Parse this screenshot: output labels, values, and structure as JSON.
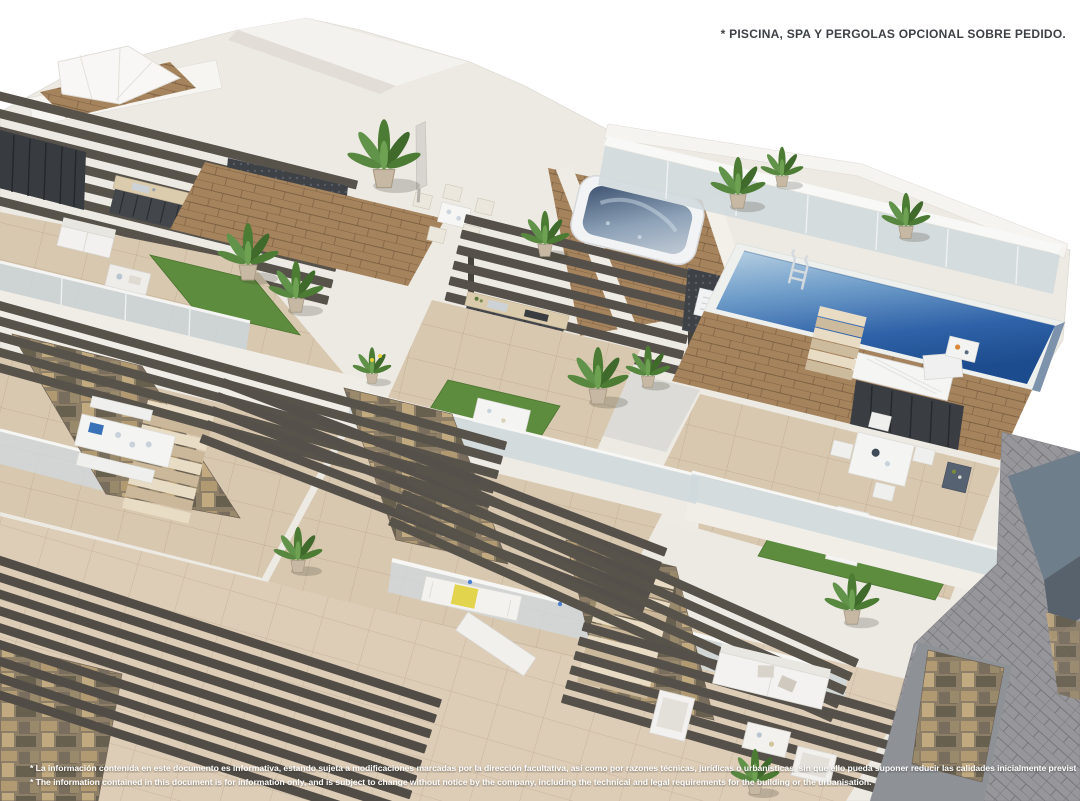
{
  "overlay": {
    "note_top_right": "* PISCINA, SPA Y PERGOLAS OPCIONAL SOBRE PEDIDO.",
    "disclaimer_es": "* La información contenida en este documento es informativa, estando sujeta a modificaciones marcadas por la dirección facultativa, así como por razones técnicas, jurídicas o urbanísticas, sin que ello pueda suponer reducir las calidades inicialmente previstas.",
    "disclaimer_en": "* The information contained in this document is for information only, and is subject to change without notice by the company, including the technical and legal requirements for the building or the urbanisation."
  },
  "palette": {
    "background": "#ffffff",
    "wall_white": "#f2f0ec",
    "floor_tile": "#d9c8b0",
    "wood_deck": "#a5835d",
    "pergola_slat": "#57534b",
    "pool_water_light": "#b7d0e2",
    "pool_water_deep": "#1d4c8e",
    "spa_water": "#2c4b74",
    "glass_balustrade": "#cfd8dc",
    "artificial_grass": "#5e8c3e",
    "stone_wall": "#8d7e68",
    "paver_grey": "#97979b",
    "note_text": "#3e4145",
    "disclaimer_text": "#ffffff"
  }
}
